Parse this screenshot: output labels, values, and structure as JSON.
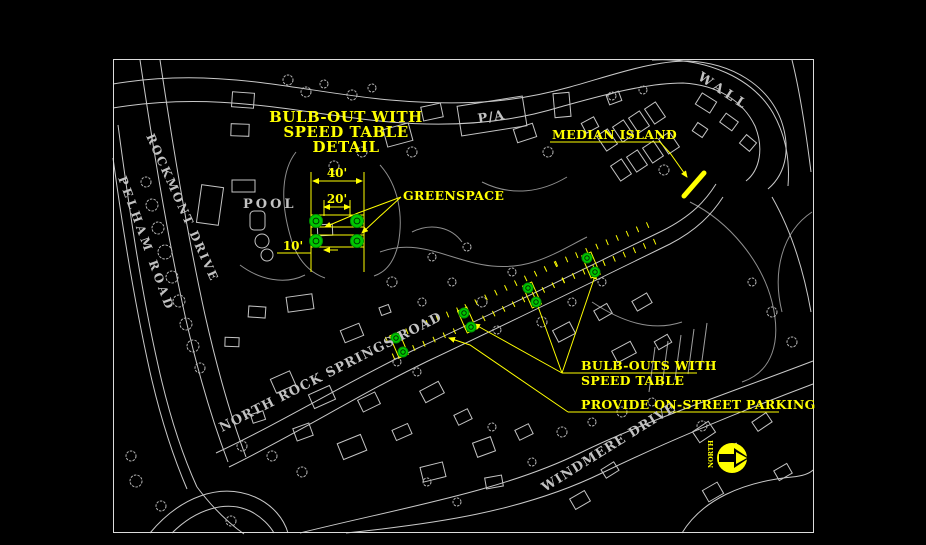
{
  "colors": {
    "background": "#000000",
    "linework": "#c9c9c9",
    "annotation": "#ffff00",
    "greenspace": "#00c800"
  },
  "detail": {
    "title_line1": "BULB-OUT WITH",
    "title_line2": "SPEED TABLE",
    "title_line3": "DETAIL",
    "dim_40": "40'",
    "dim_20": "20'",
    "dim_10": "10'",
    "greenspace_label": "GREENSPACE"
  },
  "annotations": {
    "median_island": "MEDIAN ISLAND",
    "bulb_outs_line1": "BULB-OUTS WITH",
    "bulb_outs_line2": "SPEED TABLE",
    "parking": "PROVIDE ON-STREET PARKING"
  },
  "map_labels": {
    "pool": "POOL",
    "pa": "P/A",
    "wall": "WALL",
    "north_rock_springs_road": "NORTH ROCK SPRINGS ROAD",
    "windmere_drive": "WINDMERE DRIVE",
    "rockmont_drive": "ROCKMONT DRIVE",
    "pelham_road": "PELHAM ROAD"
  },
  "north_arrow": {
    "label": "NORTH"
  }
}
